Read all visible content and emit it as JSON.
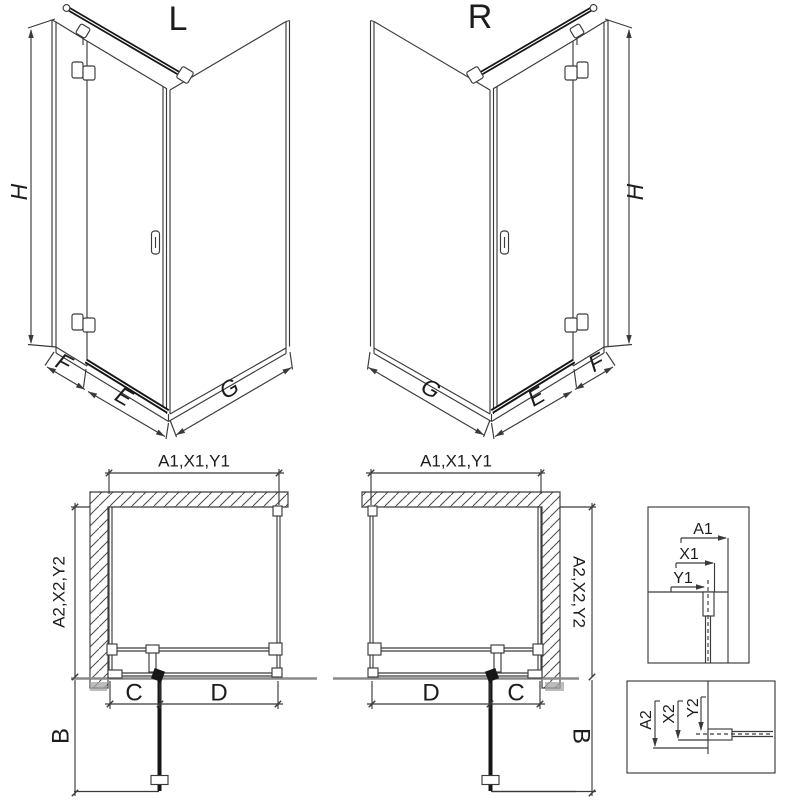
{
  "colors": {
    "ink": "#3a3a3a",
    "bold_ink": "#161616",
    "muted_gray": "#8a8a8a",
    "background": "#ffffff"
  },
  "view_l": {
    "title": "L",
    "dim_height": "H",
    "dim_fixed": "F",
    "dim_door": "E",
    "dim_side": "G"
  },
  "view_r": {
    "title": "R",
    "dim_height": "H",
    "dim_fixed": "F",
    "dim_door": "E",
    "dim_side": "G"
  },
  "plan_l": {
    "dim_top": "A1,X1,Y1",
    "dim_side": "A2,X2,Y2",
    "dim_c": "C",
    "dim_d": "D",
    "dim_b": "B"
  },
  "plan_r": {
    "dim_top": "A1,X1,Y1",
    "dim_side": "A2,X2,Y2",
    "dim_c": "C",
    "dim_d": "D",
    "dim_b": "B"
  },
  "detail_top": {
    "dim_a": "A1",
    "dim_x": "X1",
    "dim_y": "Y1"
  },
  "detail_bottom": {
    "dim_a": "A2",
    "dim_x": "X2",
    "dim_y": "Y2"
  }
}
